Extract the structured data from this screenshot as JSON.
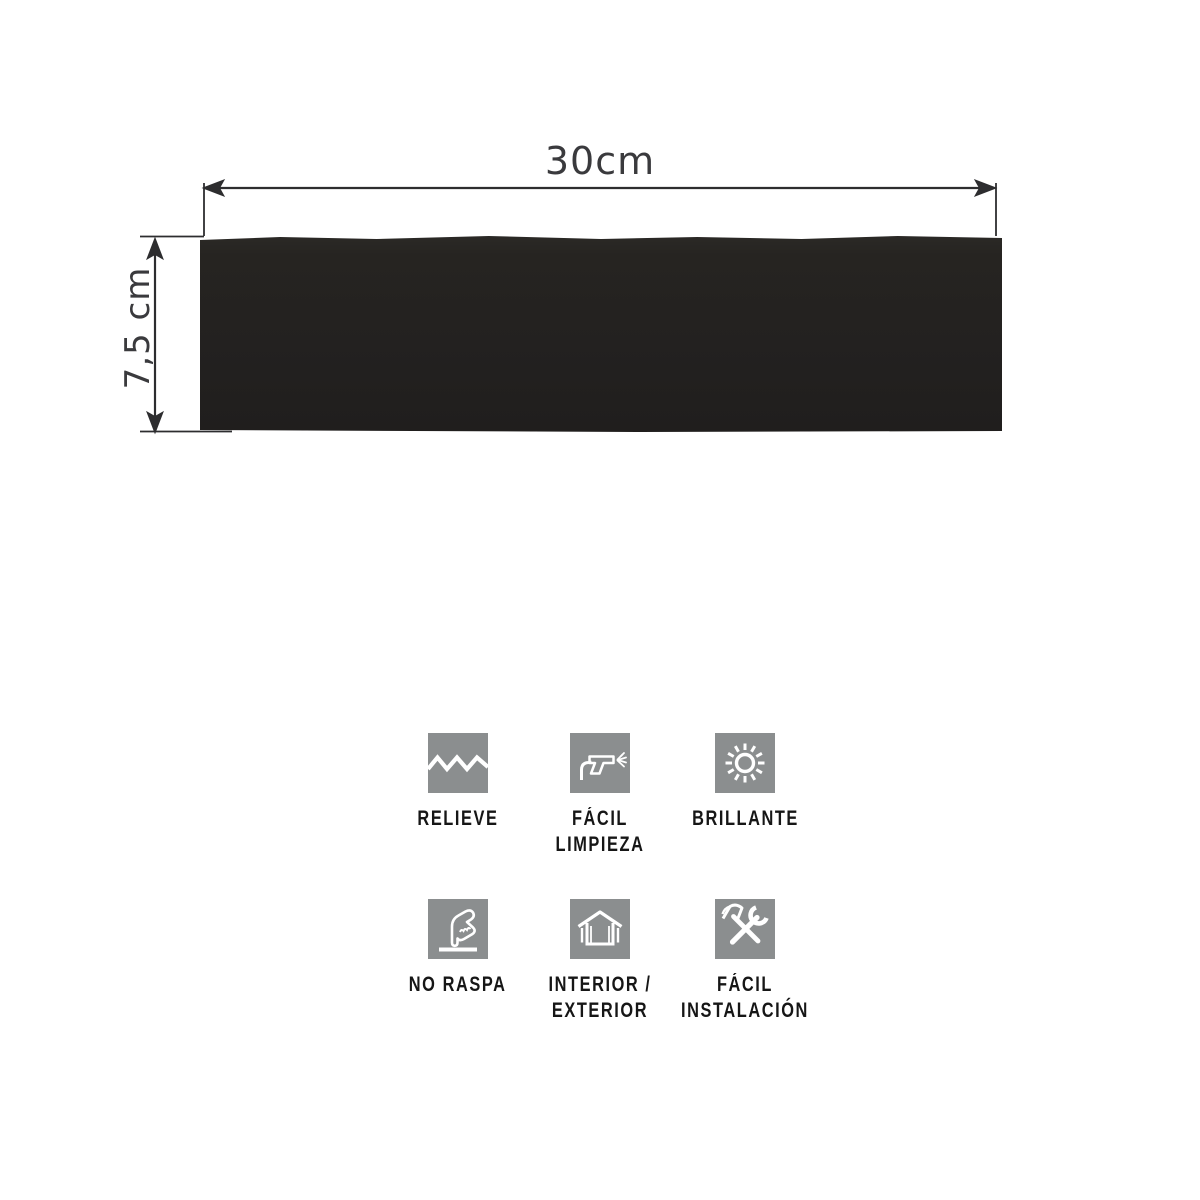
{
  "page": {
    "background_color": "#ffffff"
  },
  "diagram": {
    "width_label": "30cm",
    "height_label": "7,5 cm",
    "tile_color": "#242220",
    "dimension_line_color": "#2d2d2f",
    "dimension_text_color": "#3a3a3d"
  },
  "features": {
    "icon_background_color": "#8b8e8f",
    "icon_glyph_color": "#ffffff",
    "label_color": "#161616",
    "items": [
      {
        "icon": "relief-zigzag-icon",
        "lines": [
          "RELIEVE"
        ]
      },
      {
        "icon": "spray-gun-icon",
        "lines": [
          "FÁCIL",
          "LIMPIEZA"
        ]
      },
      {
        "icon": "sun-icon",
        "lines": [
          "BRILLANTE"
        ]
      },
      {
        "icon": "hand-touch-icon",
        "lines": [
          "NO RASPA"
        ]
      },
      {
        "icon": "house-icon",
        "lines": [
          "INTERIOR /",
          "EXTERIOR"
        ]
      },
      {
        "icon": "tools-icon",
        "lines": [
          "FÁCIL",
          "INSTALACIÓN"
        ]
      }
    ]
  }
}
